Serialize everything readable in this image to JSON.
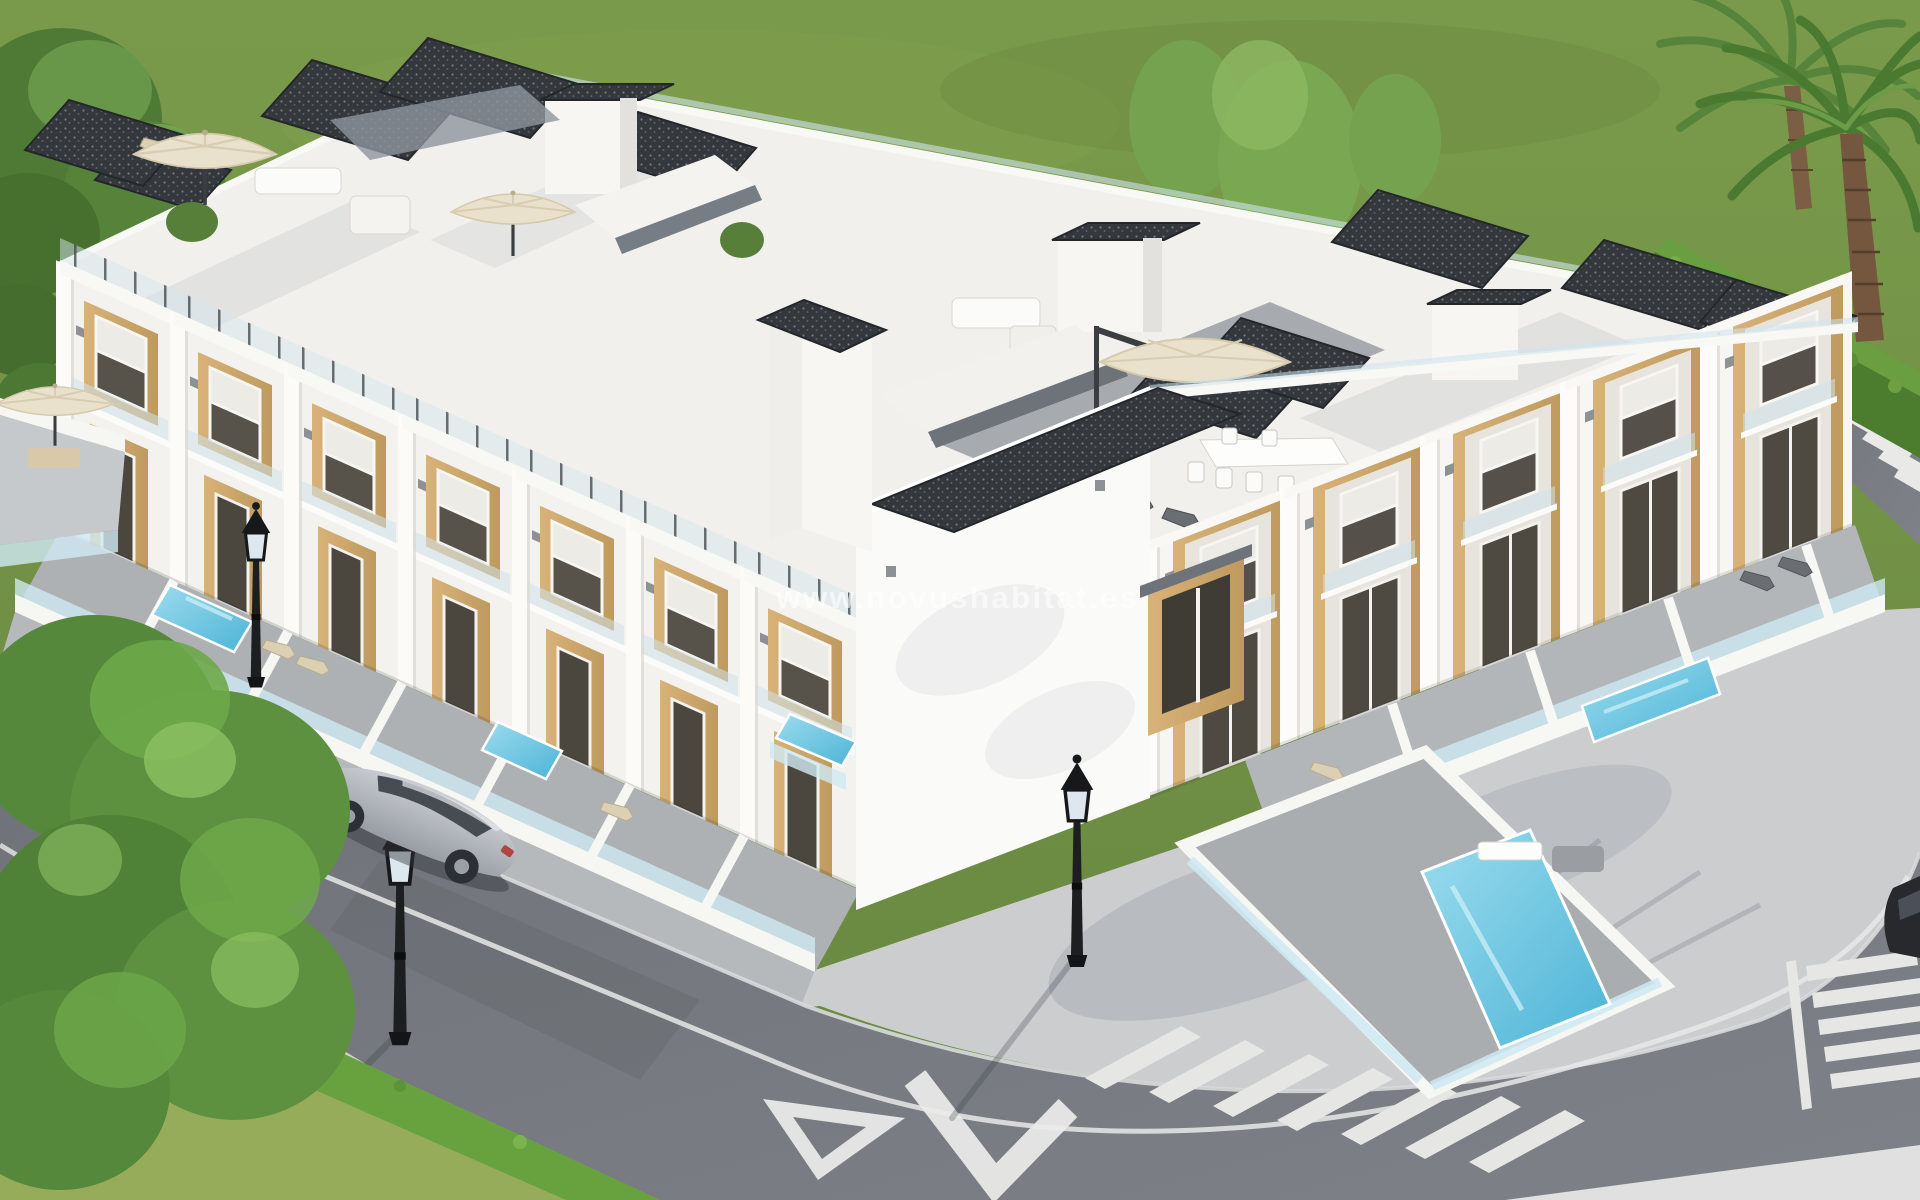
{
  "watermark": {
    "text": "www.novushabitat.es"
  },
  "scene": {
    "kind": "3D architectural render, aerial three-quarter view",
    "subject": "new-build development of modern white townhouses on a corner plot",
    "building": {
      "storeys": "2 floors plus private roof terraces (solarium)",
      "wings": 2,
      "style": "white cubic facades with light-oak wood cladding around doors and windows",
      "features": [
        "glass balustrades on balconies and roof terraces",
        "anthracite gravel roof caps and stair bulkheads",
        "cream patio umbrellas and white awnings on terraces",
        "white roller shutters on windows",
        "walled front yards with frosted-glass fence tops",
        "private turquoise plunge pools",
        "sun loungers and outdoor sofas",
        "potted green plants on balconies"
      ]
    },
    "streets": {
      "layout": "road wraps around the corner plot with wide light-concrete sidewalk plaza",
      "markings": [
        "white lane lines",
        "hollow yield triangle",
        "large white chevron arrow",
        "zebra crosswalk bottom-right",
        "zebra crosswalk right edge",
        "small zebra crosswalk top-right"
      ]
    },
    "vehicles": [
      {
        "type": "sedan",
        "color": "silver",
        "location": "driving on left street"
      },
      {
        "type": "car",
        "color": "dark grey",
        "location": "right edge, partially visible"
      }
    ],
    "street_lamps": {
      "count": 3,
      "style": "classic black lantern posts"
    },
    "pools_visible": 5,
    "umbrellas_visible": 5,
    "vegetation": [
      "leafy tree top-left",
      "large leafy tree bottom-left over lawn",
      "two palm trees top-right",
      "trimmed hedge along right-hand street",
      "slim trees behind the block",
      "green lawn surrounding the plot"
    ]
  },
  "palette": {
    "grass": "#72903f",
    "lawn_light": "#97ac5b",
    "hedge": "#5f9138",
    "tree_green": "#5d9140",
    "palm_green": "#55843a",
    "palm_trunk": "#7b5e43",
    "building_white": "#f5f4f1",
    "wood_accent": "#cfa86e",
    "roof_dark": "#34383d",
    "terrace_tile": "#a7abaf",
    "pool_water": "#5fc1de",
    "frosted_glass": "#cfeaf3",
    "asphalt": "#75787e",
    "sidewalk": "#b6b9bc",
    "plaza": "#cbcdcf",
    "marking_white": "#ebebe9",
    "umbrella_cream": "#e9e1cc",
    "car_silver": "#b9bdc2"
  }
}
